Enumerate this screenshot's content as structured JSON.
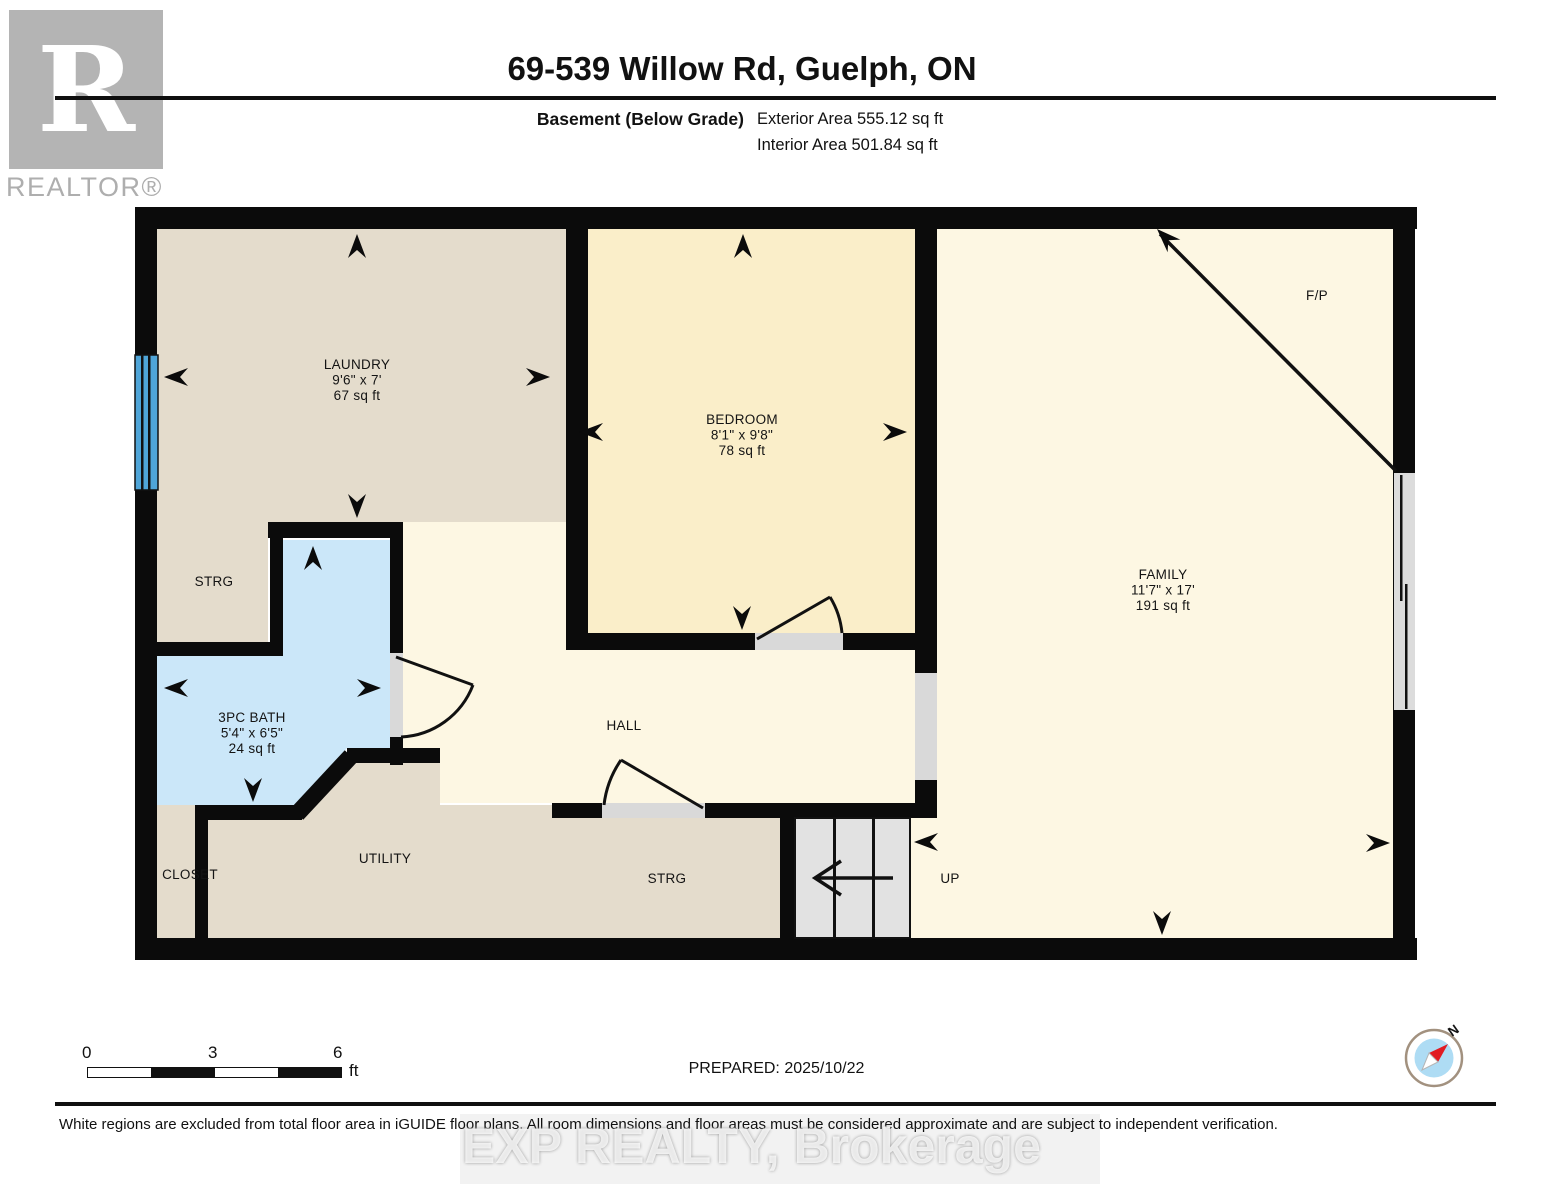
{
  "header": {
    "logo_letter": "R",
    "logo_text": "REALTOR®",
    "title": "69-539 Willow Rd, Guelph, ON",
    "floor_label": "Basement (Below Grade)",
    "exterior_area": "Exterior Area 555.12 sq ft",
    "interior_area": "Interior Area 501.84 sq ft"
  },
  "rooms": {
    "laundry": {
      "name": "LAUNDRY",
      "dims": "9'6\" x 7'",
      "area": "67 sq ft"
    },
    "bedroom": {
      "name": "BEDROOM",
      "dims": "8'1\" x 9'8\"",
      "area": "78 sq ft"
    },
    "family": {
      "name": "FAMILY",
      "dims": "11'7\" x 17'",
      "area": "191 sq ft"
    },
    "bath": {
      "name": "3PC BATH",
      "dims": "5'4\" x 6'5\"",
      "area": "24 sq ft"
    },
    "strg_upper": {
      "name": "STRG"
    },
    "strg_lower": {
      "name": "STRG"
    },
    "closet": {
      "name": "CLOSET"
    },
    "utility": {
      "name": "UTILITY"
    },
    "hall": {
      "name": "HALL"
    },
    "stairs": {
      "name": "UP"
    },
    "fireplace": {
      "name": "F/P"
    }
  },
  "scale_bar": {
    "start": "0",
    "mid": "3",
    "end": "6",
    "unit": "ft"
  },
  "footer": {
    "prepared": "PREPARED: 2025/10/22",
    "disclaimer": "White regions are excluded from total floor area in iGUIDE floor plans. All room dimensions and floor areas must be considered approximate and are subject to independent verification.",
    "watermark": "EXP REALTY, Brokerage",
    "compass_north": "N"
  },
  "colors": {
    "wall": "#0b0b0b",
    "room_beige": "#e4dccc",
    "room_cream": "#fdf7e3",
    "room_yellow": "#faeec9",
    "bath_blue": "#cbe7f9",
    "window_blue": "#4fa5d8",
    "opening_gray": "#d9d9d9",
    "stair_gray": "#e2e2e2",
    "compass_blue": "#aedcf4",
    "compass_red": "#e11b22",
    "logo_gray": "#b4b4b4"
  }
}
